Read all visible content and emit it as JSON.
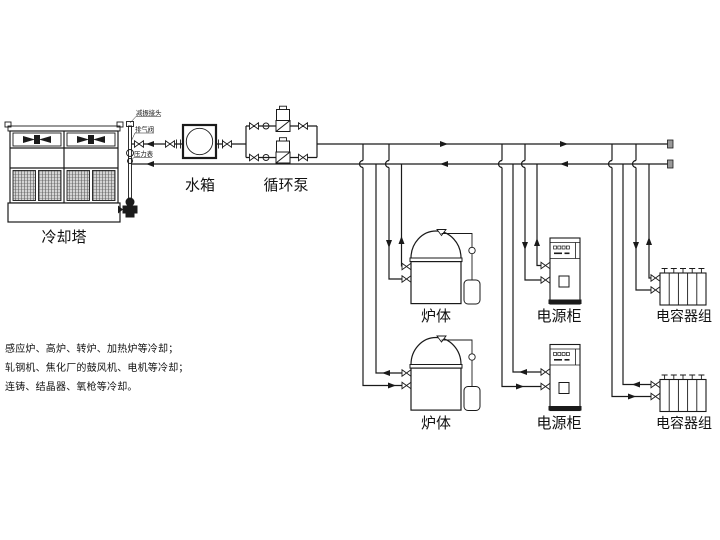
{
  "diagram": {
    "title_hint": "industrial-furnace-cooling-system-schematic",
    "components": {
      "cooling_tower": {
        "label": "冷却塔"
      },
      "water_tank": {
        "label": "水箱"
      },
      "circulation_pump": {
        "label": "循环泵"
      },
      "furnace": {
        "label": "炉体"
      },
      "power_cabinet": {
        "label": "电源柜"
      },
      "capacitor_bank": {
        "label": "电容器组"
      }
    },
    "fitting_labels": {
      "damping_joint": "减振接头",
      "air_vent_valve": "排气阀",
      "pressure_gauge": "压力表"
    },
    "description_lines": [
      "感应炉、高炉、转炉、加热炉等冷却；",
      "轧钢机、焦化厂的鼓风机、电机等冷却；",
      "连铸、结晶器、氧枪等冷却。"
    ],
    "colors": {
      "line": "#1a1a1a",
      "background": "#ffffff",
      "mesh": "#555555"
    }
  }
}
